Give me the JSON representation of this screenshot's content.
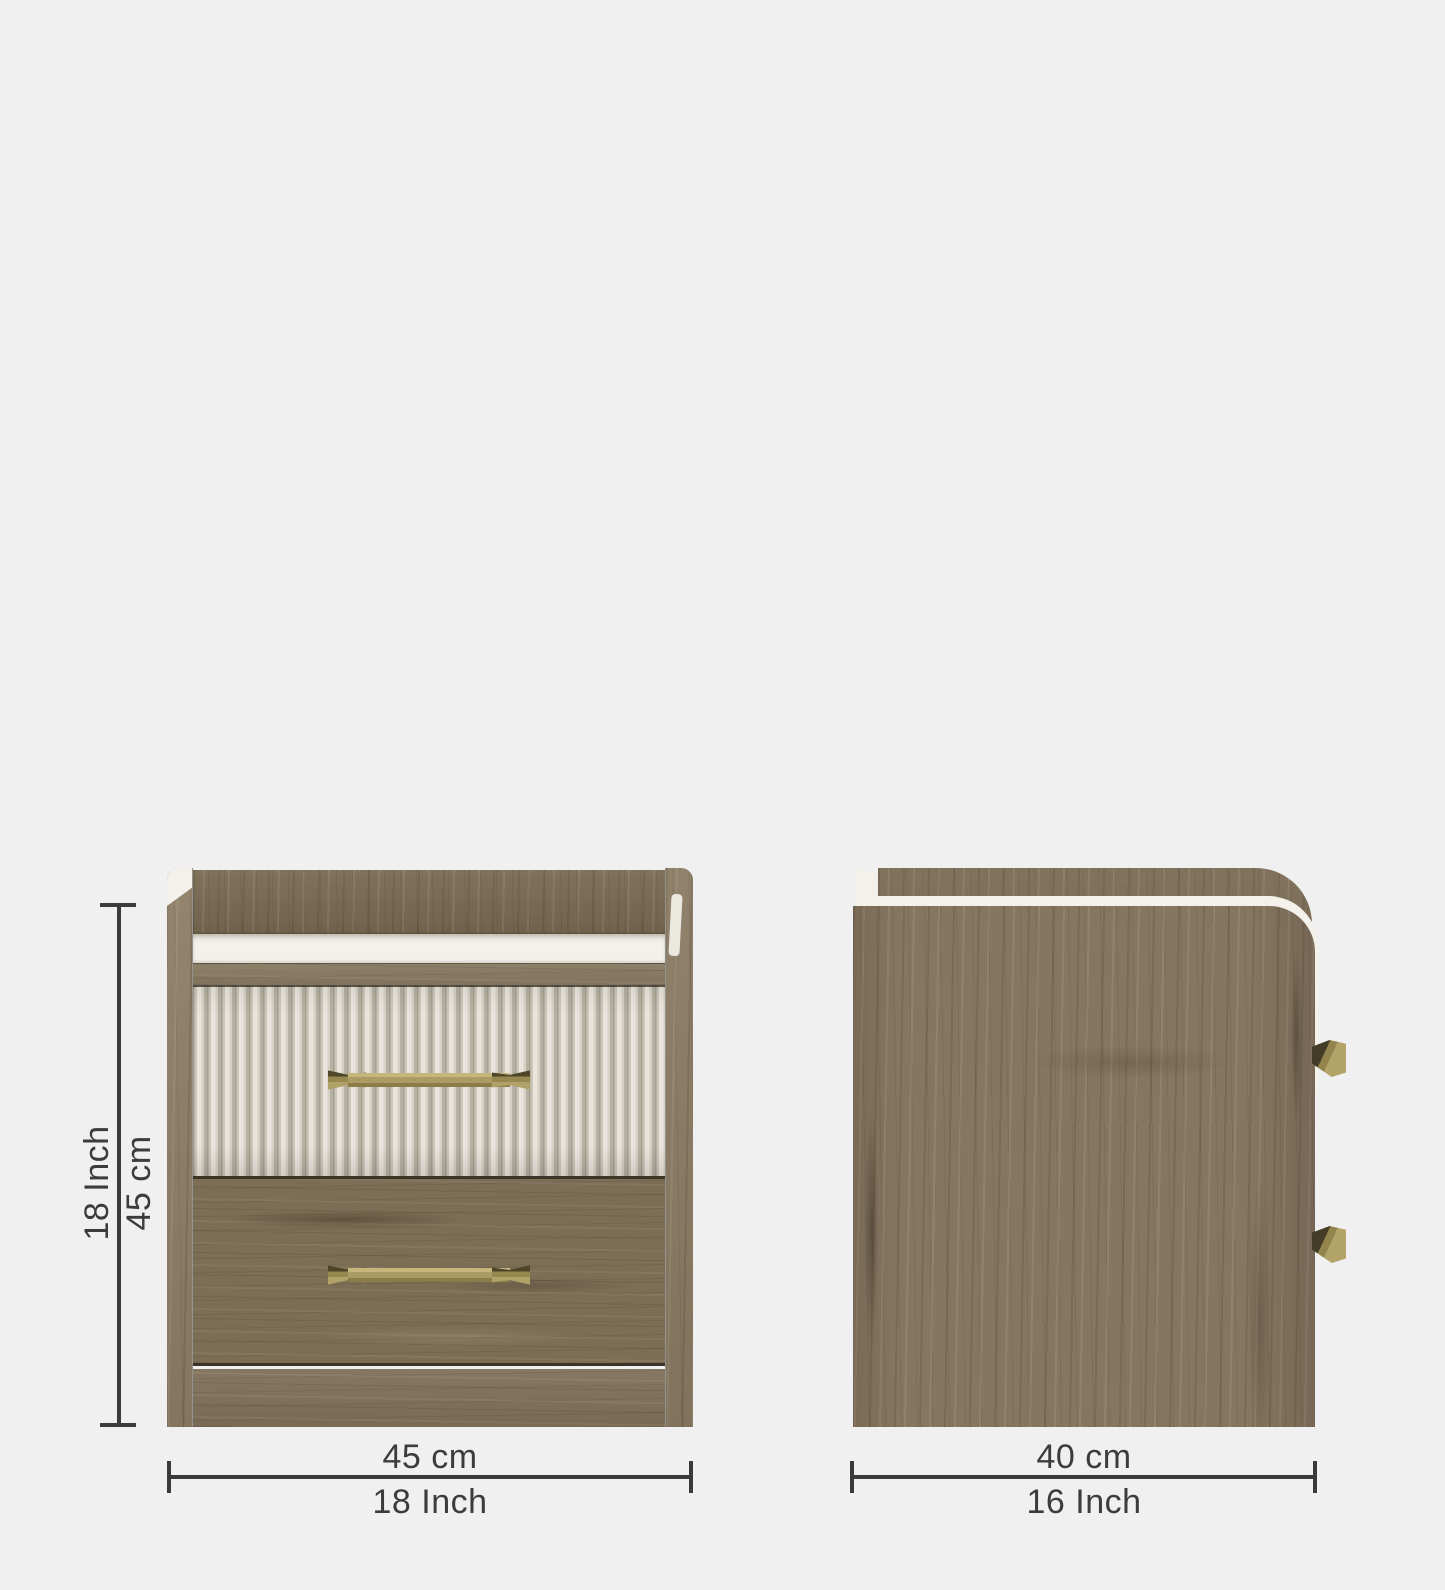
{
  "page": {
    "background_color": "#f0f0f1"
  },
  "diagram": {
    "views": [
      {
        "id": "front-view"
      },
      {
        "id": "side-view"
      }
    ],
    "annotations": {
      "height": {
        "cm": "45 cm",
        "inch": "18 Inch"
      },
      "width": {
        "cm": "45 cm",
        "inch": "18 Inch"
      },
      "depth": {
        "cm": "40 cm",
        "inch": "16 Inch"
      }
    },
    "colors": {
      "dimension_line": "#3a3a3c",
      "dimension_text": "#3c3c3e",
      "wood": "#84755d",
      "wood_dark": "#7a6b54",
      "fluted_panel": "#d8d3c7",
      "white_top": "#f3f1ea",
      "brass_handle": "#ab9c64"
    }
  }
}
